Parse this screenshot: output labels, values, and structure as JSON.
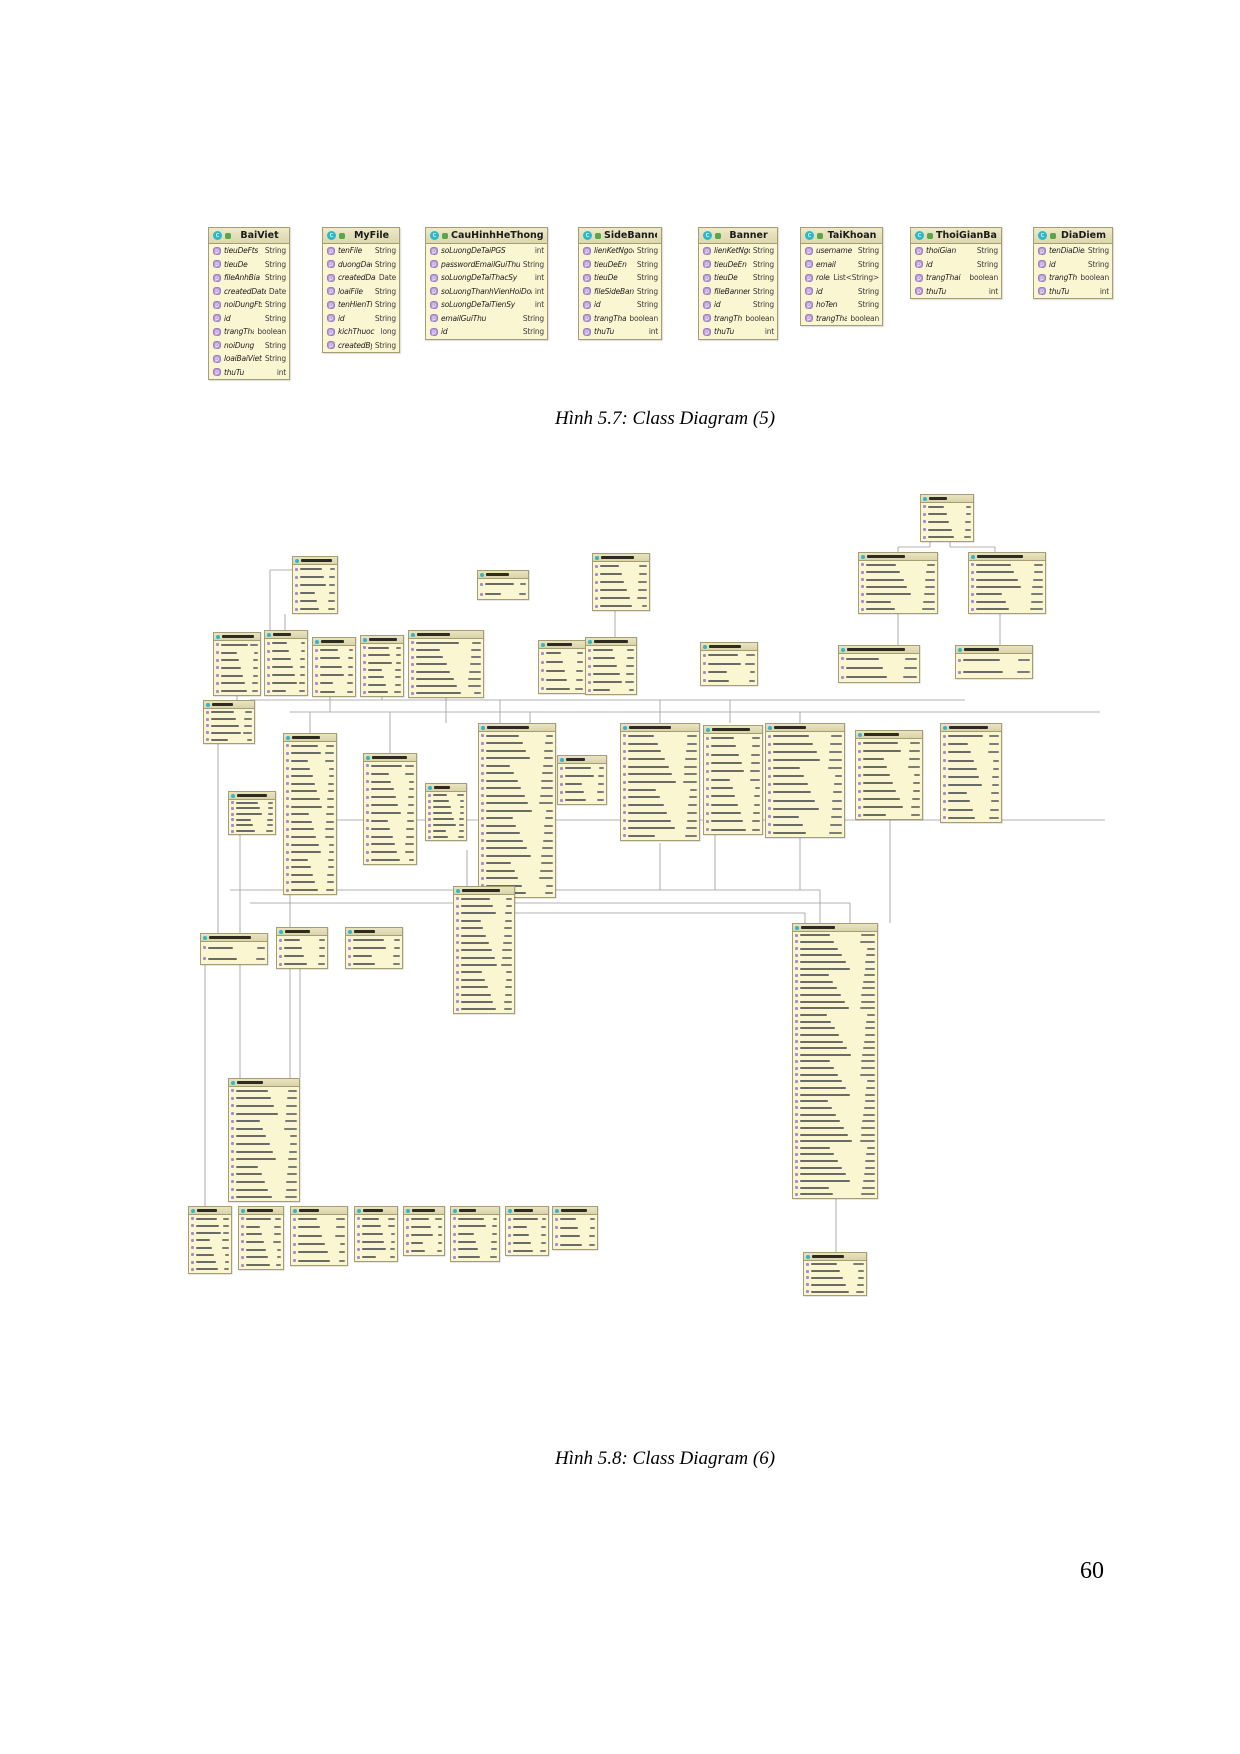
{
  "page": {
    "number": "60"
  },
  "colors": {
    "box_fill": "#fbf6d2",
    "box_header": "#e3deb6",
    "box_border": "#a59d74",
    "class_icon": "#2fb6c8",
    "field_icon": "#b79bd6",
    "connector": "#9a9a9a"
  },
  "figure1": {
    "caption": "Hình 5.7: Class Diagram (5)",
    "caption_y": 408,
    "classes": [
      {
        "name": "BaiViet",
        "x": 208,
        "y": 227,
        "w": 82,
        "fields": [
          [
            "tieuDeFts",
            "String"
          ],
          [
            "tieuDe",
            "String"
          ],
          [
            "fileAnhBia",
            "String"
          ],
          [
            "createdDate",
            "Date"
          ],
          [
            "noiDungFts",
            "String"
          ],
          [
            "id",
            "String"
          ],
          [
            "trangThai",
            "boolean"
          ],
          [
            "noiDung",
            "String"
          ],
          [
            "loaiBaiViet",
            "String"
          ],
          [
            "thuTu",
            "int"
          ]
        ]
      },
      {
        "name": "MyFile",
        "x": 322,
        "y": 227,
        "w": 78,
        "fields": [
          [
            "tenFile",
            "String"
          ],
          [
            "duongDan",
            "String"
          ],
          [
            "createdDate",
            "Date"
          ],
          [
            "loaiFile",
            "String"
          ],
          [
            "tenHienThi",
            "String"
          ],
          [
            "id",
            "String"
          ],
          [
            "kichThuoc",
            "long"
          ],
          [
            "createdBy",
            "String"
          ]
        ]
      },
      {
        "name": "CauHinhHeThong",
        "x": 425,
        "y": 227,
        "w": 123,
        "fields": [
          [
            "soLuongDeTaiPGS",
            "int"
          ],
          [
            "passwordEmailGuiThu",
            "String"
          ],
          [
            "soLuongDeTaiThacSy",
            "int"
          ],
          [
            "soLuongThanhVienHoiDong",
            "int"
          ],
          [
            "soLuongDeTaiTienSy",
            "int"
          ],
          [
            "emailGuiThu",
            "String"
          ],
          [
            "id",
            "String"
          ]
        ]
      },
      {
        "name": "SideBanner",
        "x": 578,
        "y": 227,
        "w": 84,
        "fields": [
          [
            "lienKetNgoai",
            "String"
          ],
          [
            "tieuDeEn",
            "String"
          ],
          [
            "tieuDe",
            "String"
          ],
          [
            "fileSideBanner",
            "String"
          ],
          [
            "id",
            "String"
          ],
          [
            "trangThai",
            "boolean"
          ],
          [
            "thuTu",
            "int"
          ]
        ]
      },
      {
        "name": "Banner",
        "x": 698,
        "y": 227,
        "w": 80,
        "fields": [
          [
            "lienKetNgoai",
            "String"
          ],
          [
            "tieuDeEn",
            "String"
          ],
          [
            "tieuDe",
            "String"
          ],
          [
            "fileBanner",
            "String"
          ],
          [
            "id",
            "String"
          ],
          [
            "trangThai",
            "boolean"
          ],
          [
            "thuTu",
            "int"
          ]
        ]
      },
      {
        "name": "TaiKhoan",
        "x": 800,
        "y": 227,
        "w": 83,
        "fields": [
          [
            "username",
            "String"
          ],
          [
            "email",
            "String"
          ],
          [
            "roles",
            "List<String>"
          ],
          [
            "id",
            "String"
          ],
          [
            "hoTen",
            "String"
          ],
          [
            "trangThai",
            "boolean"
          ]
        ]
      },
      {
        "name": "ThoiGianBaoVe",
        "x": 910,
        "y": 227,
        "w": 92,
        "fields": [
          [
            "thoiGian",
            "String"
          ],
          [
            "id",
            "String"
          ],
          [
            "trangThai",
            "boolean"
          ],
          [
            "thuTu",
            "int"
          ]
        ]
      },
      {
        "name": "DiaDiem",
        "x": 1033,
        "y": 227,
        "w": 80,
        "fields": [
          [
            "tenDiaDiem",
            "String"
          ],
          [
            "id",
            "String"
          ],
          [
            "trangThai",
            "boolean"
          ],
          [
            "thuTu",
            "int"
          ]
        ]
      }
    ]
  },
  "figure2": {
    "caption": "Hình 5.8: Class Diagram (6)",
    "caption_y": 1448,
    "boxes": [
      [
        920,
        494,
        54,
        48,
        5
      ],
      [
        858,
        552,
        80,
        62,
        7
      ],
      [
        968,
        552,
        78,
        62,
        7
      ],
      [
        292,
        556,
        46,
        58,
        6
      ],
      [
        477,
        570,
        52,
        30,
        2
      ],
      [
        592,
        553,
        58,
        58,
        6
      ],
      [
        838,
        645,
        82,
        38,
        3
      ],
      [
        955,
        645,
        78,
        34,
        2
      ],
      [
        700,
        642,
        58,
        44,
        4
      ],
      [
        213,
        632,
        48,
        64,
        7
      ],
      [
        264,
        630,
        44,
        66,
        7
      ],
      [
        312,
        637,
        44,
        60,
        6
      ],
      [
        360,
        635,
        44,
        62,
        7
      ],
      [
        408,
        630,
        76,
        68,
        8
      ],
      [
        538,
        640,
        48,
        54,
        5
      ],
      [
        585,
        637,
        52,
        58,
        6
      ],
      [
        203,
        700,
        52,
        44,
        5
      ],
      [
        283,
        733,
        54,
        162,
        20
      ],
      [
        363,
        753,
        54,
        112,
        13
      ],
      [
        425,
        783,
        42,
        58,
        8
      ],
      [
        478,
        723,
        78,
        175,
        22
      ],
      [
        228,
        791,
        48,
        44,
        6
      ],
      [
        557,
        755,
        50,
        50,
        5
      ],
      [
        620,
        723,
        80,
        118,
        14
      ],
      [
        703,
        725,
        60,
        110,
        12
      ],
      [
        765,
        723,
        80,
        115,
        13
      ],
      [
        855,
        730,
        68,
        90,
        10
      ],
      [
        940,
        723,
        62,
        100,
        11
      ],
      [
        792,
        923,
        86,
        276,
        40
      ],
      [
        803,
        1252,
        64,
        44,
        5
      ],
      [
        453,
        886,
        62,
        128,
        16
      ],
      [
        345,
        927,
        58,
        42,
        4
      ],
      [
        276,
        927,
        52,
        42,
        4
      ],
      [
        200,
        933,
        68,
        32,
        2
      ],
      [
        228,
        1078,
        72,
        124,
        15
      ],
      [
        188,
        1206,
        44,
        68,
        8
      ],
      [
        238,
        1206,
        46,
        64,
        7
      ],
      [
        290,
        1206,
        58,
        60,
        6
      ],
      [
        354,
        1206,
        44,
        56,
        6
      ],
      [
        403,
        1206,
        42,
        50,
        5
      ],
      [
        450,
        1206,
        50,
        56,
        6
      ],
      [
        505,
        1206,
        44,
        50,
        5
      ],
      [
        552,
        1206,
        46,
        44,
        4
      ]
    ],
    "connectors": [
      [
        250,
        700,
        965,
        700
      ],
      [
        290,
        712,
        1100,
        712
      ],
      [
        293,
        820,
        1105,
        820
      ],
      [
        292,
        570,
        270,
        570
      ],
      [
        270,
        570,
        270,
        632
      ],
      [
        285,
        614,
        285,
        630
      ],
      [
        237,
        696,
        237,
        700
      ],
      [
        330,
        697,
        330,
        712
      ],
      [
        382,
        697,
        382,
        700
      ],
      [
        446,
        698,
        446,
        723
      ],
      [
        500,
        700,
        500,
        723
      ],
      [
        530,
        712,
        530,
        723
      ],
      [
        390,
        712,
        390,
        753
      ],
      [
        310,
        712,
        310,
        733
      ],
      [
        660,
        700,
        660,
        723
      ],
      [
        730,
        700,
        730,
        723
      ],
      [
        800,
        712,
        800,
        723
      ],
      [
        930,
        542,
        930,
        547
      ],
      [
        930,
        547,
        898,
        547
      ],
      [
        898,
        547,
        898,
        552
      ],
      [
        950,
        542,
        950,
        547
      ],
      [
        950,
        547,
        995,
        547
      ],
      [
        995,
        547,
        995,
        552
      ],
      [
        898,
        614,
        898,
        645
      ],
      [
        1000,
        614,
        1000,
        645
      ],
      [
        615,
        611,
        615,
        637
      ],
      [
        230,
        890,
        820,
        890
      ],
      [
        820,
        890,
        820,
        923
      ],
      [
        250,
        903,
        850,
        903
      ],
      [
        850,
        903,
        850,
        923
      ],
      [
        460,
        913,
        805,
        913
      ],
      [
        805,
        913,
        805,
        923
      ],
      [
        890,
        820,
        890,
        923
      ],
      [
        836,
        1199,
        836,
        1252
      ],
      [
        240,
        835,
        240,
        1078
      ],
      [
        290,
        895,
        290,
        1078
      ],
      [
        467,
        850,
        467,
        886
      ],
      [
        218,
        744,
        218,
        933
      ],
      [
        660,
        843,
        660,
        890
      ],
      [
        800,
        838,
        800,
        890
      ],
      [
        715,
        835,
        715,
        890
      ],
      [
        205,
        965,
        205,
        1206
      ],
      [
        300,
        969,
        300,
        1078
      ]
    ]
  }
}
